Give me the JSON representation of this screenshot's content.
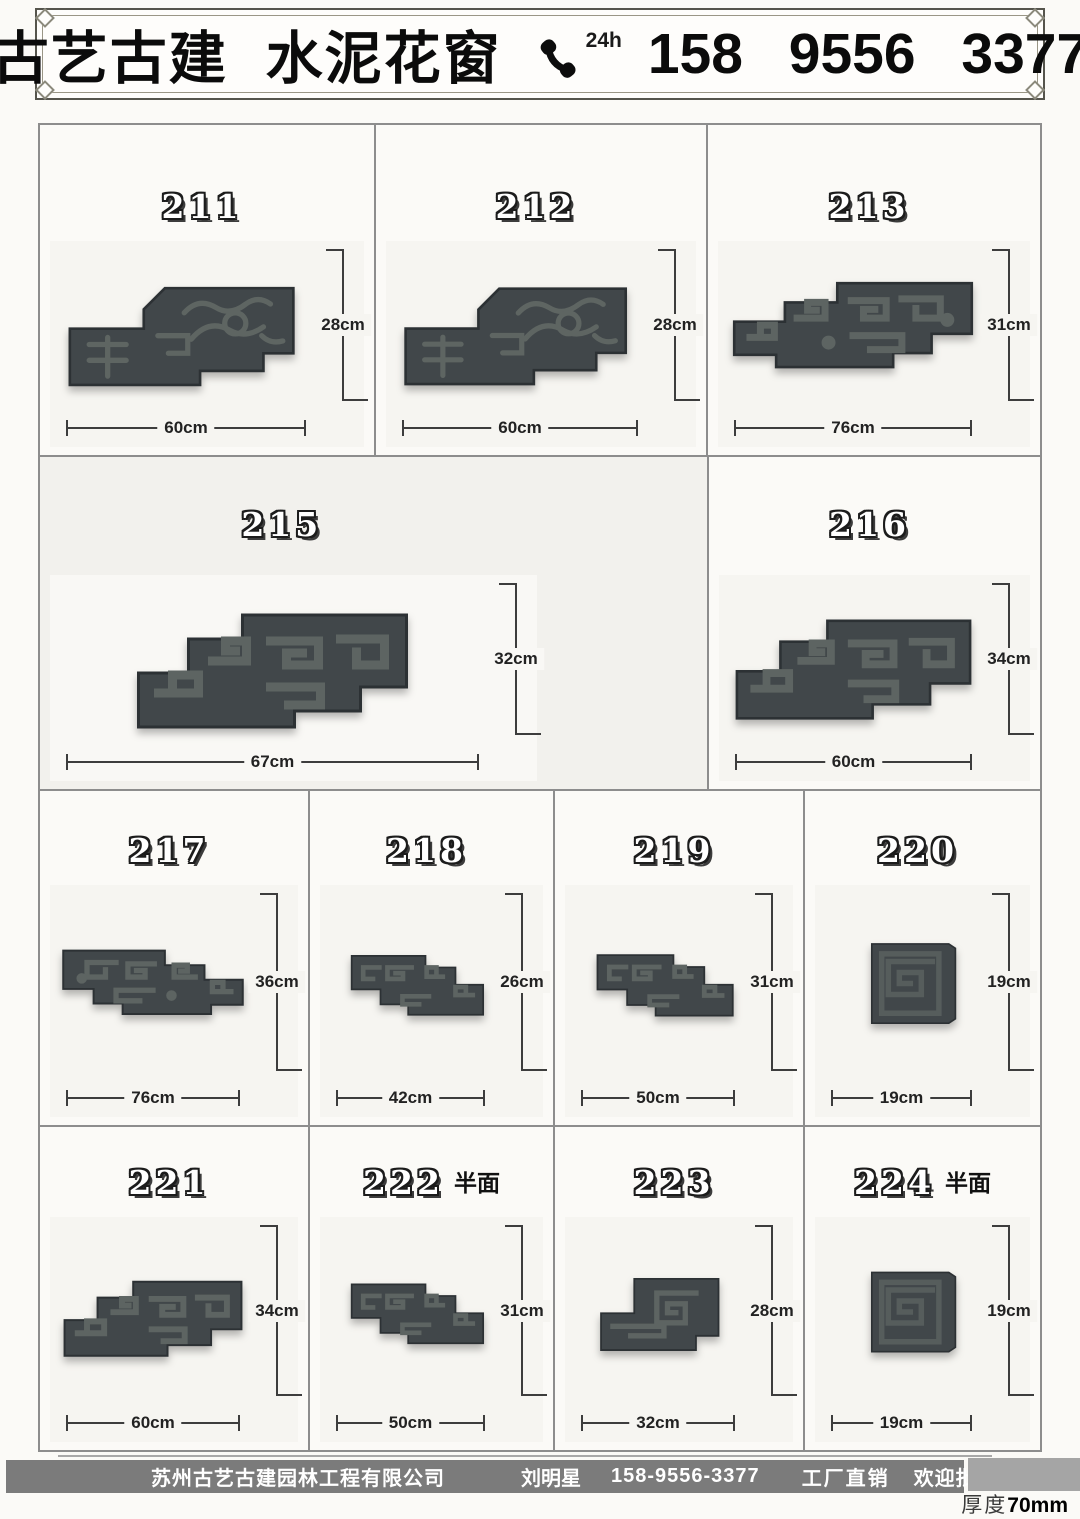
{
  "header": {
    "title": "古艺古建 水泥花窗",
    "phone_badge": "24h",
    "phone_number": "158 9556 3377"
  },
  "items": [
    {
      "number": "211",
      "suffix": "",
      "width": "60cm",
      "height": "28cm"
    },
    {
      "number": "212",
      "suffix": "",
      "width": "60cm",
      "height": "28cm"
    },
    {
      "number": "213",
      "suffix": "",
      "width": "76cm",
      "height": "31cm"
    },
    {
      "number": "215",
      "suffix": "",
      "width": "67cm",
      "height": "32cm"
    },
    {
      "number": "216",
      "suffix": "",
      "width": "60cm",
      "height": "34cm"
    },
    {
      "number": "217",
      "suffix": "",
      "width": "76cm",
      "height": "36cm"
    },
    {
      "number": "218",
      "suffix": "",
      "width": "42cm",
      "height": "26cm"
    },
    {
      "number": "219",
      "suffix": "",
      "width": "50cm",
      "height": "31cm"
    },
    {
      "number": "220",
      "suffix": "",
      "width": "19cm",
      "height": "19cm"
    },
    {
      "number": "221",
      "suffix": "",
      "width": "60cm",
      "height": "34cm"
    },
    {
      "number": "222",
      "suffix": "半面",
      "width": "50cm",
      "height": "31cm"
    },
    {
      "number": "223",
      "suffix": "",
      "width": "32cm",
      "height": "28cm"
    },
    {
      "number": "224",
      "suffix": "半面",
      "width": "19cm",
      "height": "19cm"
    }
  ],
  "footer": {
    "company": "苏州古艺古建园林工程有限公司",
    "contact_name": "刘明星",
    "contact_phone": "158-9556-3377",
    "sales_note_1": "工厂直销",
    "sales_note_2": "欢迎批发定制",
    "thickness_label": "厚度",
    "thickness_value": "70mm"
  },
  "colors": {
    "concrete": "#41474a",
    "footer_bar": "#7b7b7b",
    "text": "#0b0b0b"
  }
}
